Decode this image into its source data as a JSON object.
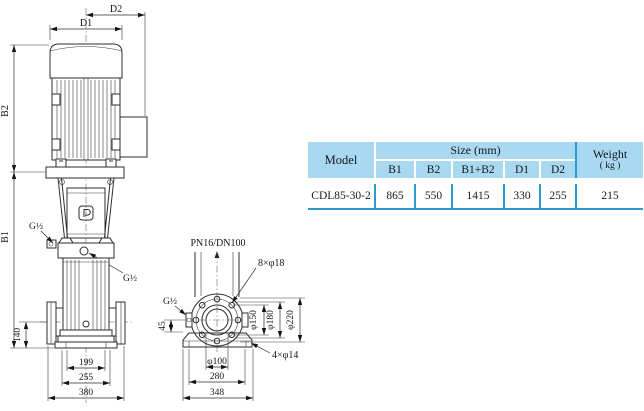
{
  "table": {
    "header": {
      "model": "Model",
      "size_group": "Size (mm)",
      "weight_line1": "Weight",
      "weight_line2": "( kg )",
      "columns": [
        "B1",
        "B2",
        "B1+B2",
        "D1",
        "D2"
      ]
    },
    "rows": [
      {
        "model": "CDL85-30-2",
        "b1": "865",
        "b2": "550",
        "b1b2": "1415",
        "d1": "330",
        "d2": "255",
        "weight": "215"
      }
    ]
  },
  "side_view": {
    "d2": "D2",
    "d1": "D1",
    "b2": "B2",
    "b1": "B1",
    "g_half_top": "G½",
    "g_half_mid": "G½",
    "h140": "140",
    "w199": "199",
    "w255": "255",
    "w380": "380"
  },
  "flange_view": {
    "spec": "PN16/DN100",
    "bolts": "8×φ18",
    "g_half": "G½",
    "h45": "45",
    "d150": "φ150",
    "d180": "φ180",
    "d220": "φ220",
    "base_holes": "4×φ14",
    "d100": "φ100",
    "w280": "280",
    "w348": "348"
  },
  "colors": {
    "table_header_bg": "#a8d9f1",
    "table_line_blue": "#2a9bd5",
    "drawing_stroke": "#2d2d2d"
  }
}
